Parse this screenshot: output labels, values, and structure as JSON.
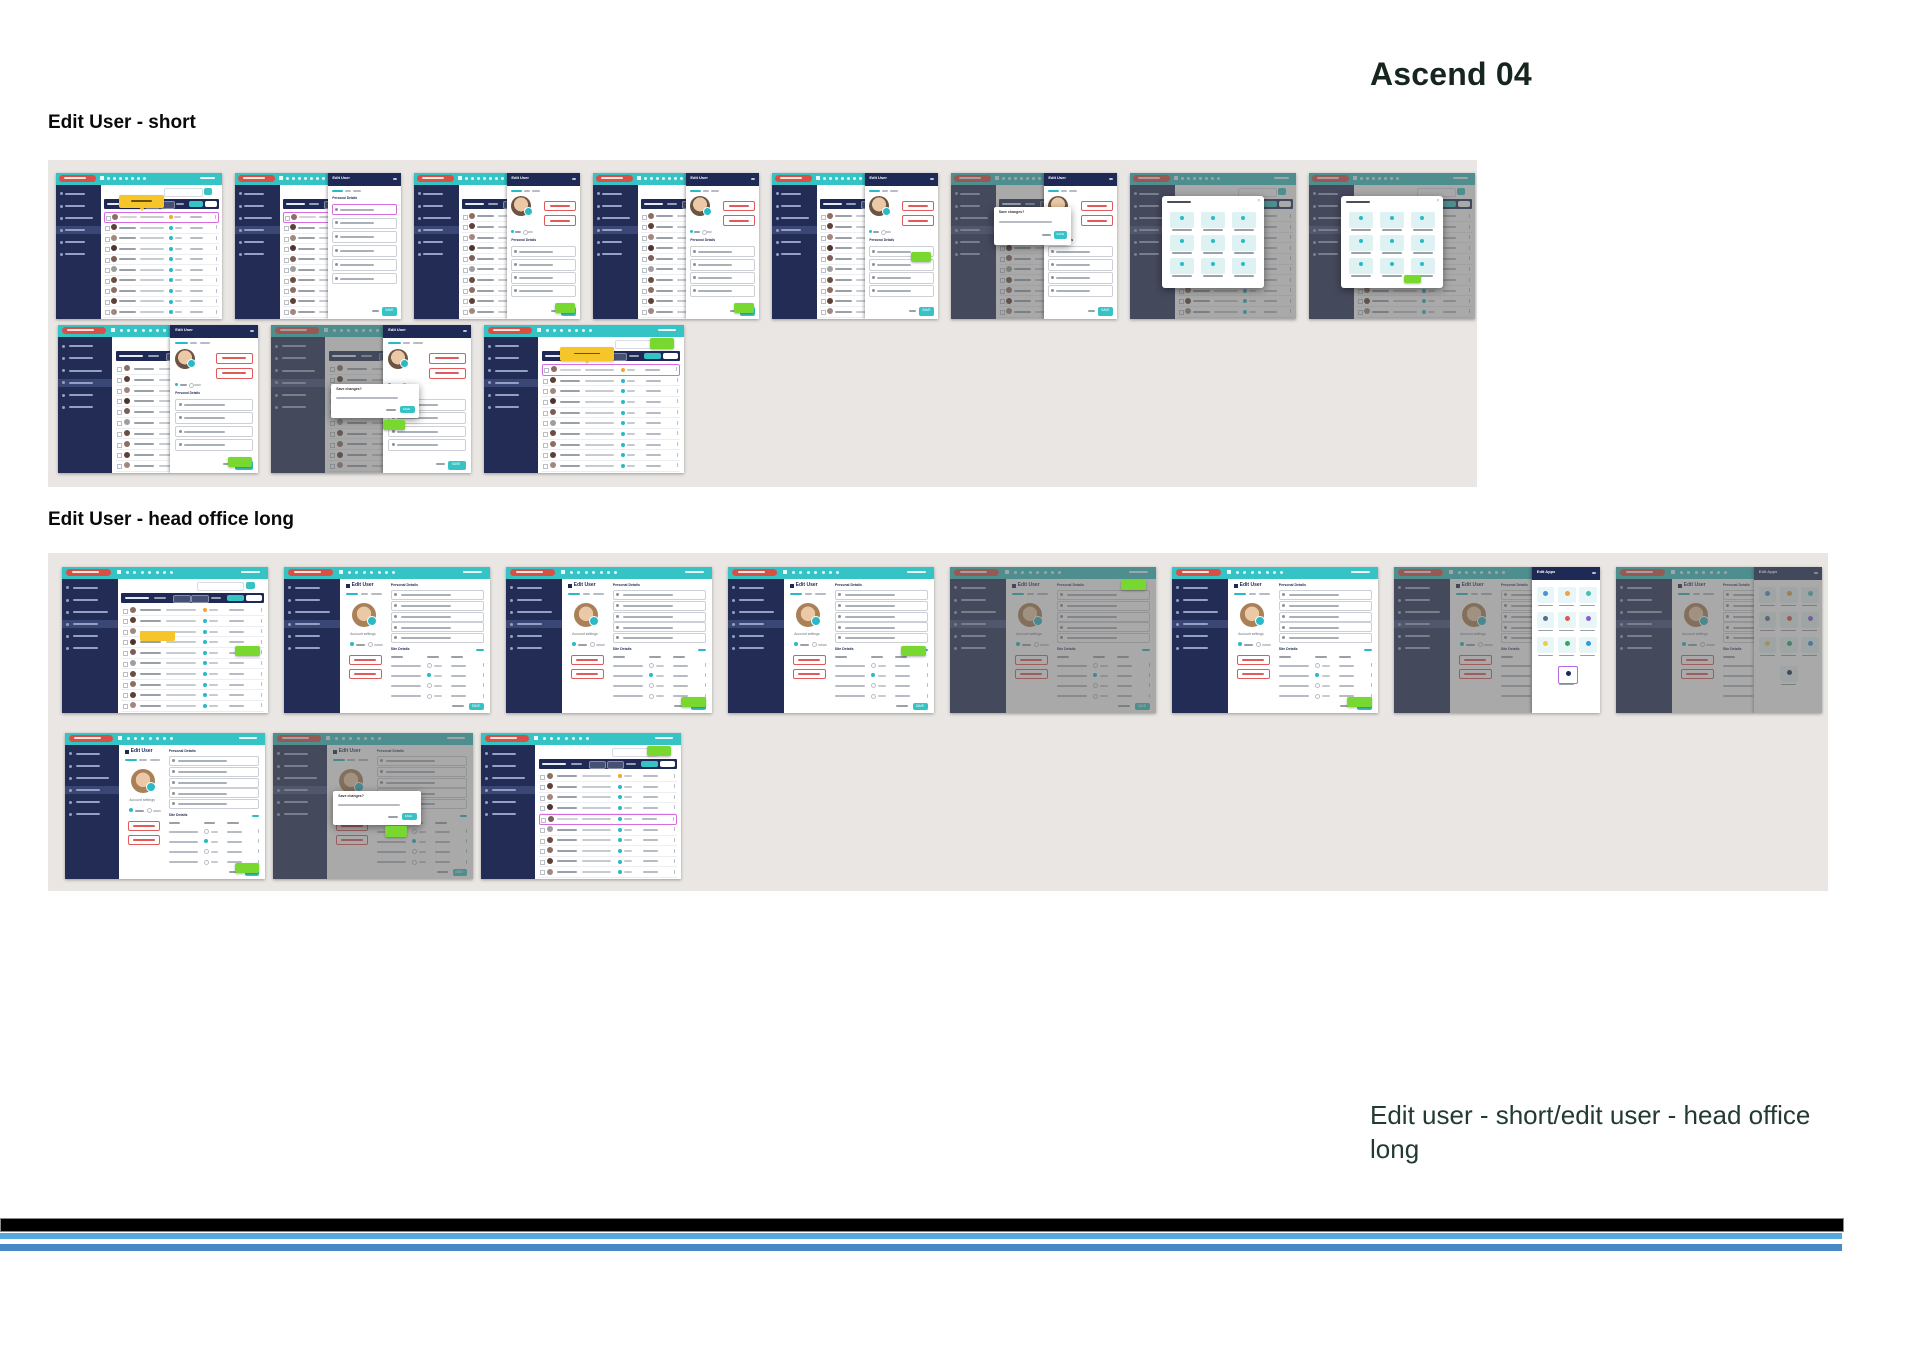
{
  "page": {
    "title": "Ascend 04",
    "caption_line1": "Edit user - short/edit user - head office",
    "caption_line2": "long"
  },
  "app_labels": {
    "edit_user": "Edit User",
    "edit_apps": "Edit Apps",
    "personal_details": "Personal Details",
    "site_details": "Site Details",
    "account_settings": "Account settings",
    "save": "SAVE",
    "cancel": "Cancel",
    "save_changes": "Save changes?",
    "configuration": "Configuration"
  },
  "colors": {
    "teal": "#35c3c5",
    "navy": "#1e2a55",
    "sidebar": "#232c54",
    "red_pill": "#d94f43",
    "status_teal": "#29b9c7",
    "status_orange": "#f5a623",
    "yellow_tooltip": "#f6c52a",
    "green_tooltip": "#79d82f",
    "pink_row": "#d86be0",
    "band_grey": "#e9e6e3",
    "stripe_black": "#000000",
    "stripe_blue_light": "#55a9e0",
    "stripe_blue_dark": "#4a87c7",
    "dim_overlay": "rgba(99,99,99,0.55)"
  },
  "footer_stripes": [
    {
      "name": "black-bar",
      "y": 1218,
      "h": 12,
      "w": 1842,
      "color": "#000000"
    },
    {
      "name": "blue-light",
      "y": 1233,
      "h": 6,
      "w": 1842,
      "color": "#55a9e0"
    },
    {
      "name": "blue-dark",
      "y": 1244,
      "h": 7,
      "w": 1842,
      "color": "#4a87c7"
    }
  ],
  "sections": [
    {
      "heading": "Edit User - short",
      "heading_x": 48,
      "heading_y": 112,
      "band": {
        "x": 48,
        "y": 160,
        "w": 1429,
        "h": 327
      },
      "rows": [
        {
          "y": 173,
          "h": 146,
          "w": 166,
          "tiles": [
            {
              "x": 56,
              "view": "user-list-highlighted-row",
              "screen": "list",
              "accents": [
                "pink-row",
                "yellow-tooltip-top"
              ]
            },
            {
              "x": 235,
              "view": "user-list-edit-panel",
              "screen": "list",
              "panel": "edit",
              "accents": [
                "pink-row"
              ]
            },
            {
              "x": 414,
              "view": "user-list-edit-panel-photo",
              "screen": "list",
              "panel": "edit-photo",
              "accents": [
                "green-bottom-right"
              ]
            },
            {
              "x": 593,
              "view": "user-list-edit-panel-photo",
              "screen": "list",
              "panel": "edit-photo",
              "accents": [
                "green-bottom-right"
              ]
            },
            {
              "x": 772,
              "view": "user-list-edit-panel-photo",
              "screen": "list",
              "panel": "edit-photo",
              "accents": [
                "green-mid-right"
              ]
            },
            {
              "x": 951,
              "view": "edit-panel-confirm-dialog",
              "screen": "list",
              "panel": "edit-photo",
              "dim": true,
              "modal": "confirm"
            },
            {
              "x": 1130,
              "view": "icon-picker-dialog",
              "screen": "list",
              "dim": true,
              "modal": "icons"
            },
            {
              "x": 1309,
              "view": "icon-picker-dialog-annotated",
              "screen": "list",
              "dim": true,
              "modal": "icons",
              "accents": [
                "green-modal"
              ]
            }
          ]
        },
        {
          "y": 325,
          "h": 148,
          "w": 200,
          "tiles": [
            {
              "x": 58,
              "view": "user-list-edit-panel-photo",
              "screen": "list",
              "panel": "edit-photo",
              "accents": [
                "green-bottom-right"
              ]
            },
            {
              "x": 271,
              "view": "save-changes-dialog",
              "screen": "list",
              "panel": "edit-photo",
              "dim": true,
              "modal": "save",
              "accents": [
                "green-under-modal"
              ]
            },
            {
              "x": 484,
              "view": "user-list-highlighted-row",
              "screen": "list",
              "accents": [
                "pink-row",
                "yellow-tooltip-top",
                "green-top-right"
              ]
            }
          ]
        }
      ]
    },
    {
      "heading": "Edit User - head office long",
      "heading_x": 48,
      "heading_y": 509,
      "band": {
        "x": 48,
        "y": 553,
        "w": 1780,
        "h": 338
      },
      "rows": [
        {
          "y": 567,
          "h": 146,
          "w": 206,
          "tiles": [
            {
              "x": 62,
              "view": "user-list-highlighted-cell",
              "screen": "list",
              "accents": [
                "yellow-row-mid",
                "green-mid-right"
              ]
            },
            {
              "x": 284,
              "view": "edit-user-form",
              "screen": "form"
            },
            {
              "x": 506,
              "view": "edit-user-form-annotated",
              "screen": "form",
              "accents": [
                "green-bottom-right"
              ]
            },
            {
              "x": 728,
              "view": "edit-user-form-annotated",
              "screen": "form",
              "accents": [
                "green-mid-right"
              ]
            },
            {
              "x": 950,
              "view": "edit-user-form-dimmed",
              "screen": "form",
              "dim": true,
              "accents": [
                "green-top-right"
              ]
            },
            {
              "x": 1172,
              "view": "edit-user-form-annotated",
              "screen": "form",
              "accents": [
                "green-bottom-right"
              ]
            },
            {
              "x": 1394,
              "view": "edit-apps-panel",
              "screen": "form",
              "dim": true,
              "panel": "apps",
              "accents": [
                "purple-icon"
              ]
            },
            {
              "x": 1616,
              "view": "edit-apps-panel-dimmed",
              "screen": "form",
              "dim": "all",
              "panel": "apps"
            }
          ]
        },
        {
          "y": 733,
          "h": 146,
          "w": 200,
          "tiles": [
            {
              "x": 65,
              "view": "edit-user-form-annotated",
              "screen": "form",
              "accents": [
                "green-bottom-right"
              ]
            },
            {
              "x": 273,
              "view": "save-changes-dialog",
              "screen": "form",
              "dim": true,
              "modal": "save",
              "accents": [
                "green-under-modal"
              ]
            },
            {
              "x": 481,
              "view": "user-list-highlighted-row",
              "screen": "list",
              "accents": [
                "pink-row-mid",
                "green-top-right"
              ]
            }
          ]
        }
      ]
    }
  ]
}
